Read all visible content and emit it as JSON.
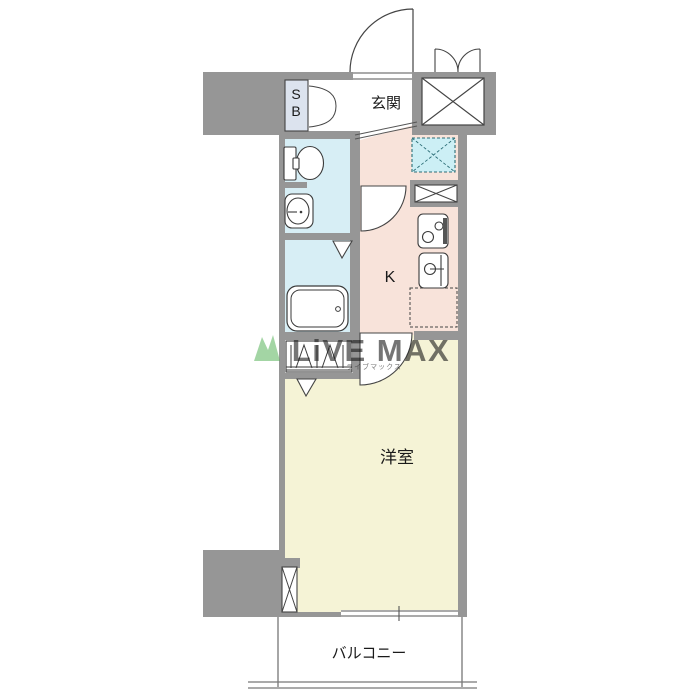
{
  "floorplan": {
    "labels": {
      "entrance": "玄関",
      "shoe_box_s": "S",
      "shoe_box_b": "B",
      "kitchen": "K",
      "western_room": "洋室",
      "balcony": "バルコニー"
    },
    "watermark": {
      "brand": "LiVE MAX",
      "subtext": "ライブマックス"
    },
    "colors": {
      "wall": "#969696",
      "wet_area": "#d7eef5",
      "kitchen": "#f8e3da",
      "room": "#f5f3d6",
      "meter_box": "#cceff5",
      "shoe_box": "#dce3ee",
      "watermark_blue": "#b6c2e1",
      "watermark_green": "#4cae4f"
    }
  }
}
